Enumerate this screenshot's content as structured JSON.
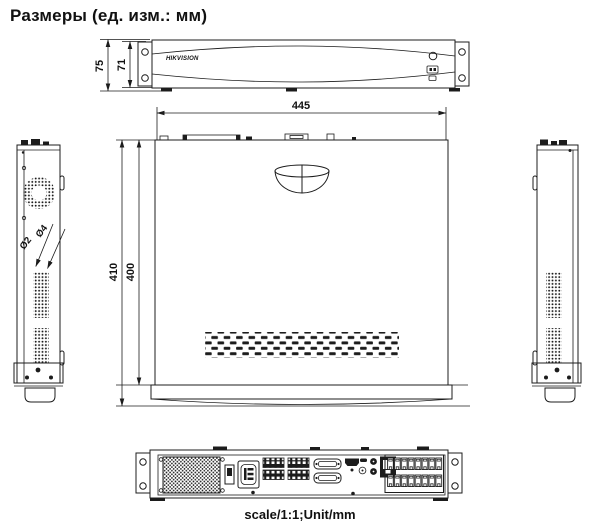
{
  "title": "Размеры (ед. изм.: мм)",
  "footer": {
    "scale_note": "scale/1:1;Unit/mm"
  },
  "front_view": {
    "brand": "HIKVISION",
    "dim_height_outer": "75",
    "dim_height_inner": "71"
  },
  "top_view": {
    "dim_width": "445",
    "dim_depth_outer": "410",
    "dim_depth_inner": "400"
  },
  "left_side_view": {
    "dim_hole_large": "Ø4",
    "dim_hole_small": "Ø2"
  },
  "colors": {
    "line": "#1c1c1c",
    "background": "#ffffff"
  }
}
